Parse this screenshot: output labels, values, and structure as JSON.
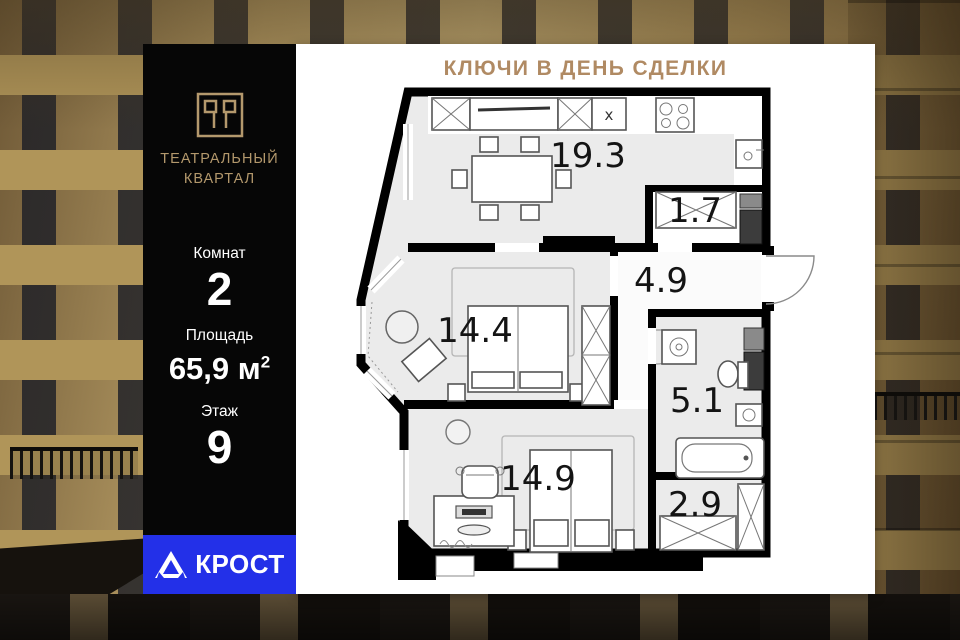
{
  "banner": {
    "title": "КЛЮЧИ В ДЕНЬ СДЕЛКИ"
  },
  "brand": {
    "name_line1": "ТЕАТРАЛЬНЫЙ",
    "name_line2": "КВАРТАЛ"
  },
  "specs": {
    "rooms_label": "Комнат",
    "rooms_value": "2",
    "area_label": "Площадь",
    "area_value": "65,9",
    "area_unit": "м",
    "area_exponent": "2",
    "floor_label": "Этаж",
    "floor_value": "9"
  },
  "developer": {
    "name": "КРОСТ"
  },
  "floorplan": {
    "rooms": [
      {
        "name": "kitchen-living",
        "area": "19.3"
      },
      {
        "name": "entry-closet",
        "area": "1.7"
      },
      {
        "name": "hallway",
        "area": "4.9"
      },
      {
        "name": "bedroom-1",
        "area": "14.4"
      },
      {
        "name": "bathroom",
        "area": "5.1"
      },
      {
        "name": "bedroom-2",
        "area": "14.9"
      },
      {
        "name": "storage",
        "area": "2.9"
      }
    ],
    "cabinet_marker": "x"
  },
  "colors": {
    "accent_gold": "#b3986c",
    "banner_title": "#b08a63",
    "developer_blue": "#2330e8"
  }
}
